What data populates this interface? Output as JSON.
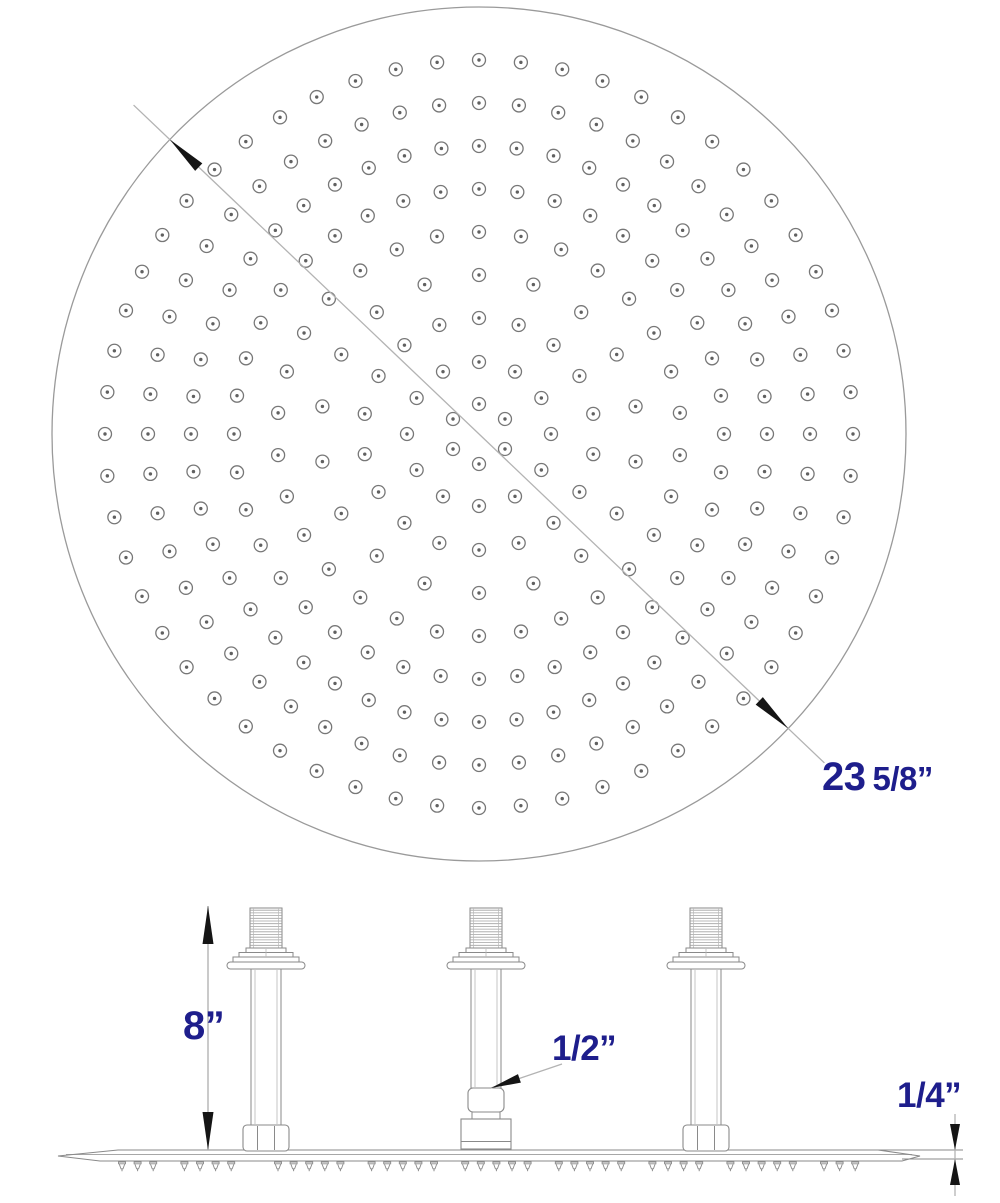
{
  "colors": {
    "outline": "#9a9a9a",
    "nozzle": "#777777",
    "nozzle_dot": "#606060",
    "line": "#8a8a8a",
    "line_light": "#b8b8b8",
    "dimline": "#b3b3b3",
    "arrow": "#151515",
    "dim_text": "#1e1e8c",
    "background": "#ffffff"
  },
  "dimensions": {
    "diameter": {
      "whole": "23",
      "fraction": "5/8”"
    },
    "height": {
      "label": "8”"
    },
    "inlet": {
      "label": "1/2”"
    },
    "thickness": {
      "label": "1/4”"
    }
  },
  "drawing": {
    "face": {
      "cx": 479,
      "cy": 434,
      "radius": 427,
      "nozzle": {
        "outer_r": 6.5,
        "dot_r": 1.7
      },
      "rings": [
        {
          "r": 30,
          "n": 6,
          "offset": 90
        },
        {
          "r": 72,
          "n": 12,
          "offset": 90
        },
        {
          "r": 116,
          "n": 18,
          "offset": 10
        },
        {
          "r": 159,
          "n": 18,
          "offset": 10
        },
        {
          "r": 202,
          "n": 30,
          "offset": 6
        },
        {
          "r": 245,
          "n": 40,
          "offset": 0
        },
        {
          "r": 288,
          "n": 48,
          "offset": 0
        },
        {
          "r": 331,
          "n": 52,
          "offset": 0
        },
        {
          "r": 374,
          "n": 56,
          "offset": 0
        }
      ],
      "dim_angle_deg": 43.6,
      "dim_overhang": 50,
      "arrow_len": 40,
      "arrow_halfw": 5.2
    },
    "side": {
      "plate": {
        "outline": [
          [
            58,
            1156
          ],
          [
            118,
            1150
          ],
          [
            878,
            1150
          ],
          [
            920,
            1156
          ],
          [
            902,
            1161
          ],
          [
            100,
            1161
          ]
        ],
        "inner_line": [
          66,
          1154.5,
          912
        ]
      },
      "spray": {
        "start": 122,
        "spacing": 15.6,
        "count": 48,
        "skip": [
          3,
          8,
          9,
          15,
          21,
          27,
          33,
          38,
          44
        ],
        "y": 1162
      },
      "arm_geom": {
        "threads": {
          "w": 32,
          "y1": 908,
          "y2": 948,
          "pitch": 2.7
        },
        "steps": [
          {
            "w": 40,
            "y": 948,
            "h": 5
          },
          {
            "w": 54,
            "y": 952.5,
            "h": 5.5
          },
          {
            "w": 66,
            "y": 957,
            "h": 5.5
          }
        ],
        "flange": {
          "w": 78,
          "y": 962,
          "h": 7,
          "rx": 3.5
        },
        "pipe": {
          "w": 30,
          "inner_off": 11,
          "top": 969
        },
        "nut": {
          "w": 46,
          "y": 1125,
          "h": 26,
          "rx": 4,
          "facet_off": 8.5
        },
        "coupler": {
          "w": 36,
          "y": 1088,
          "h": 24,
          "rx": 5,
          "neck_w": 28,
          "neck_y": 1112,
          "neck_h": 7,
          "base_w": 50,
          "base_y": 1119,
          "base_h": 30,
          "base_line_y": 1141.5
        }
      },
      "arms": [
        {
          "cx": 266,
          "bottom": "nut"
        },
        {
          "cx": 486,
          "bottom": "coupler"
        },
        {
          "cx": 706,
          "bottom": "nut"
        }
      ],
      "dims": {
        "height": {
          "x": 208,
          "y1": 906,
          "y2": 1150,
          "arrow_len": 38,
          "arrow_halfw": 5.5
        },
        "inlet": {
          "x1": 562,
          "y1": 1064,
          "x2": 491,
          "y2": 1088,
          "arrow_len": 30,
          "arrow_halfw": 4.5
        },
        "thickness": {
          "x": 955,
          "top": 1114,
          "bottom": 1196,
          "edge1": 1150,
          "edge2": 1159,
          "ext1_x1": 878,
          "ext2_x1": 902,
          "ext_x2": 963,
          "arrow_len": 26,
          "arrow_halfw": 5
        }
      }
    }
  }
}
